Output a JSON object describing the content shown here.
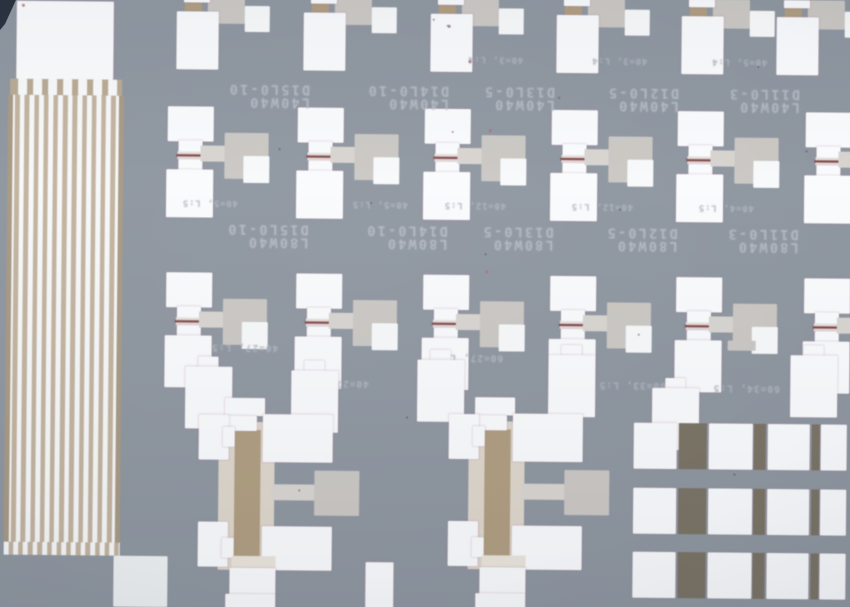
{
  "scene": {
    "type": "optical-micrograph",
    "subject": "MEMS test-structure die",
    "text_orientation": "rotated-180"
  },
  "labels": {
    "row1": [
      {
        "small": "",
        "name": "D15L0-10",
        "dims": "L40W40"
      },
      {
        "small": "",
        "name": "D14L0-10",
        "dims": "L40W40"
      },
      {
        "small": "40=3, L:4",
        "name": "D13L0-5",
        "dims": "L40W40"
      },
      {
        "small": "40=3, L:4",
        "name": "D12L0-5",
        "dims": "L40W40"
      },
      {
        "small": "40=5, L:4",
        "name": "D11L0-3",
        "dims": "L40W40"
      }
    ],
    "row2": [
      {
        "small": "40=5, L:5",
        "name": "D15L0-10",
        "dims": "L80W40"
      },
      {
        "small": "40=5, L:5",
        "name": "D14L0-10",
        "dims": "L80W40"
      },
      {
        "small": "40=12, L:5",
        "name": "D13L0-5",
        "dims": "L80W40"
      },
      {
        "small": "40=12, L:5",
        "name": "D12L0-5",
        "dims": "L80W40"
      },
      {
        "small": "40=4, L:5",
        "name": "D11L0-3",
        "dims": "L80W40"
      }
    ],
    "row3_small": [
      "40=27, L:5",
      "40=27, L:5",
      "60=27, L:5",
      "60=33, L:5",
      "60=34, L:5"
    ]
  },
  "colors": {
    "background": "#8f97a1",
    "pad_white": "#f9fbfd",
    "plate_grey": "#cbc8c4",
    "arm_grey": "#d8d5d1",
    "tan_bar": "#b09e81",
    "tan_field": "#c3b4a0",
    "field_edge": "#a89a85",
    "beige_surround": "#ded7cc",
    "olive_dark": "#7b7466",
    "beam_red": "#7c4a49",
    "label_text": "#b6bbc5",
    "corner_dark": "#2b3240"
  }
}
